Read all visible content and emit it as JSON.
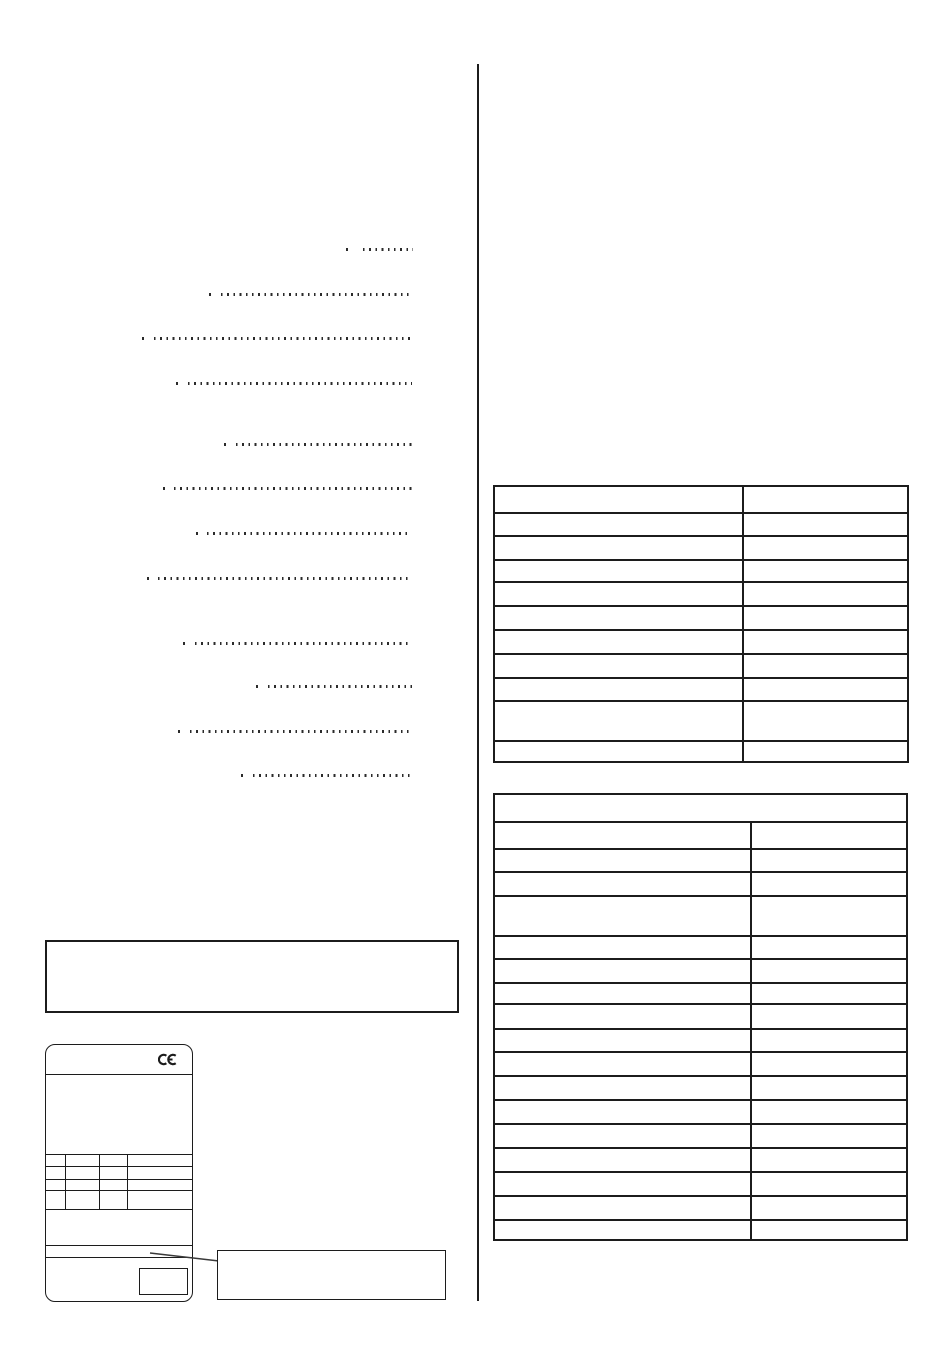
{
  "page": {
    "width": 950,
    "height": 1370,
    "background": "#ffffff",
    "ink_color": "#1c1c1c"
  },
  "column_divider": {
    "x": 477,
    "top": 64,
    "bottom": 1301
  },
  "toc_leaders": {
    "dot_color": "#2b2b2b",
    "lines": [
      {
        "y": 250,
        "dot_x": 346,
        "run_start": 363,
        "run_end": 413
      },
      {
        "y": 295,
        "dot_x": 209,
        "run_start": 221,
        "run_end": 412
      },
      {
        "y": 339,
        "dot_x": 142,
        "run_start": 154,
        "run_end": 412
      },
      {
        "y": 384,
        "dot_x": 176,
        "run_start": 188,
        "run_end": 412
      },
      {
        "y": 445,
        "dot_x": 224,
        "run_start": 236,
        "run_end": 412
      },
      {
        "y": 489,
        "dot_x": 163,
        "run_start": 174,
        "run_end": 412
      },
      {
        "y": 534,
        "dot_x": 196,
        "run_start": 207,
        "run_end": 411
      },
      {
        "y": 579,
        "dot_x": 147,
        "run_start": 158,
        "run_end": 412
      },
      {
        "y": 644,
        "dot_x": 183,
        "run_start": 195,
        "run_end": 412
      },
      {
        "y": 687,
        "dot_x": 256,
        "run_start": 268,
        "run_end": 412
      },
      {
        "y": 732,
        "dot_x": 178,
        "run_start": 190,
        "run_end": 411
      },
      {
        "y": 776,
        "dot_x": 241,
        "run_start": 253,
        "run_end": 411
      }
    ]
  },
  "spec_table_top": {
    "x": 493,
    "y": 485,
    "width": 416,
    "height": 278,
    "col_split": 247,
    "rows": [
      {
        "height": 25,
        "label": "",
        "value": ""
      },
      {
        "height": 23,
        "label": "",
        "value": ""
      },
      {
        "height": 24,
        "label": "",
        "value": ""
      },
      {
        "height": 22,
        "label": "",
        "value": ""
      },
      {
        "height": 24,
        "label": "",
        "value": ""
      },
      {
        "height": 24,
        "label": "",
        "value": ""
      },
      {
        "height": 24,
        "label": "",
        "value": ""
      },
      {
        "height": 24,
        "label": "",
        "value": ""
      },
      {
        "height": 23,
        "label": "",
        "value": ""
      },
      {
        "height": 40,
        "label": "",
        "value": ""
      },
      {
        "height": 25,
        "label": "",
        "value": ""
      }
    ]
  },
  "spec_table_bottom": {
    "x": 493,
    "y": 793,
    "width": 415,
    "height": 448,
    "col_split": 255,
    "header": {
      "height": 26,
      "text": ""
    },
    "rows": [
      {
        "height": 27,
        "label": "",
        "value": ""
      },
      {
        "height": 23,
        "label": "",
        "value": ""
      },
      {
        "height": 24,
        "label": "",
        "value": ""
      },
      {
        "height": 40,
        "label": "",
        "value": ""
      },
      {
        "height": 23,
        "label": "",
        "value": ""
      },
      {
        "height": 24,
        "label": "",
        "value": ""
      },
      {
        "height": 21,
        "label": "",
        "value": ""
      },
      {
        "height": 25,
        "label": "",
        "value": ""
      },
      {
        "height": 23,
        "label": "",
        "value": ""
      },
      {
        "height": 24,
        "label": "",
        "value": ""
      },
      {
        "height": 24,
        "label": "",
        "value": ""
      },
      {
        "height": 24,
        "label": "",
        "value": ""
      },
      {
        "height": 24,
        "label": "",
        "value": ""
      },
      {
        "height": 24,
        "label": "",
        "value": ""
      },
      {
        "height": 24,
        "label": "",
        "value": ""
      },
      {
        "height": 24,
        "label": "",
        "value": ""
      },
      {
        "height": 24,
        "label": "",
        "value": ""
      }
    ]
  },
  "note_box": {
    "x": 45,
    "y": 940,
    "width": 414,
    "height": 73,
    "text": ""
  },
  "device_label": {
    "x": 45,
    "y": 1044,
    "width": 148,
    "height": 258,
    "corner_radius": 10,
    "ce_mark": {
      "icon": "ce-mark",
      "text": "CE"
    },
    "sections": {
      "ce_row_height": 30,
      "body_height": 80,
      "grid_height": 55,
      "spacer_height": 36,
      "narrow_row_height": 12
    },
    "grid": {
      "row_heights": [
        12,
        13,
        11,
        19
      ],
      "col_widths": [
        20,
        34,
        28
      ]
    },
    "small_box": {
      "x": 93,
      "y": 10,
      "width": 49,
      "height": 27,
      "text": ""
    }
  },
  "callout": {
    "box": {
      "x": 217,
      "y": 1250,
      "width": 229,
      "height": 50,
      "text": ""
    },
    "line": {
      "x1": 150,
      "y1": 1253,
      "x2": 219,
      "y2": 1261
    }
  }
}
